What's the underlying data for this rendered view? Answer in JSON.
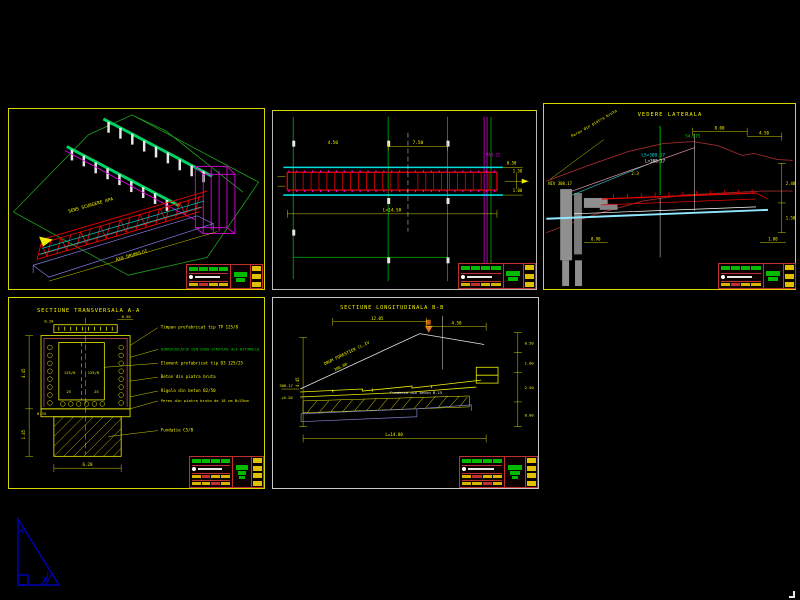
{
  "meta": {
    "background": "#000000",
    "drawing_type": "CAD culvert drawing sheet, 5 viewports"
  },
  "colors": {
    "frame_yellow": "#d8d800",
    "beam_green": "#00d264",
    "structure_red": "#e80000",
    "magenta": "#e000e0",
    "cyan": "#00dede",
    "terrain_dark_red": "#9b2a2a",
    "dim_yellow": "#f0f000",
    "stamp_green": "#00bb00",
    "titleblock_red": "#c03030",
    "triangle_blue": "#0000b0",
    "pier_gray": "#909090"
  },
  "iso_view": {
    "label_flow": "SENS SCURGERE APA",
    "label_axis": "AXA DRUMULUI"
  },
  "plan_view": {
    "dims": {
      "d1": "4.50",
      "d2": "7.50",
      "d3": "1.50",
      "d4": "1.00",
      "total": "L=14.50",
      "var_note": "VAR 25",
      "end_right": "0.50"
    }
  },
  "lateral_view": {
    "title": "VEDERE LATERALA",
    "labels": {
      "ls_level": "LS=308.17",
      "l_level": "L=308.17",
      "elev_green": "54.075",
      "niv": "NIV 308.17",
      "pereu": "Pereu din piatra bruta",
      "d_800": "8.00",
      "d_450": "4.50",
      "d_240": "2.40",
      "d_150": "1.50",
      "d_090": "0.90",
      "d_100": "1.00",
      "slope_23": "2:3"
    }
  },
  "cross_section": {
    "title": "SECTIUNE TRANSVERSALA A-A",
    "callouts": [
      "Timpan prefabricat tip TP 125/8",
      "HIDROIZOLATIE DIN DOUA STRATURI ALE BITUMULUI",
      "Element prefabricat tip D3 125/25",
      "Beton din piatra bruta",
      "Rigola din beton B2/50",
      "Pereu din piatra bruta de 18 cm B=25cm",
      "Fundatie C5/B"
    ],
    "dims": {
      "top": "0.20",
      "top2": "0.50",
      "left_h": "4.45",
      "left_f": "1.45",
      "cell_l": "125/8",
      "cell_r": "125/8",
      "slope_l": "25",
      "slope_r": "25",
      "bottom": "6.20",
      "base": "0.35"
    }
  },
  "long_section": {
    "title": "SECTIUNE LONGITUDINALA B-B",
    "labels": {
      "road": "DRUM FORESTIER CL.IV",
      "road_val": "306.00",
      "fundatie": "Fundatie din beton B.15",
      "d_top": "12.05",
      "d_top2": "4.50",
      "d_r1": "0.50",
      "d_r2": "1.00",
      "d_r3": "2.50",
      "d_r4": "8.00",
      "d_left": "4.45",
      "bottom_total": "L=14.00",
      "lvl": "308.17",
      "plus": "+0.20"
    }
  }
}
